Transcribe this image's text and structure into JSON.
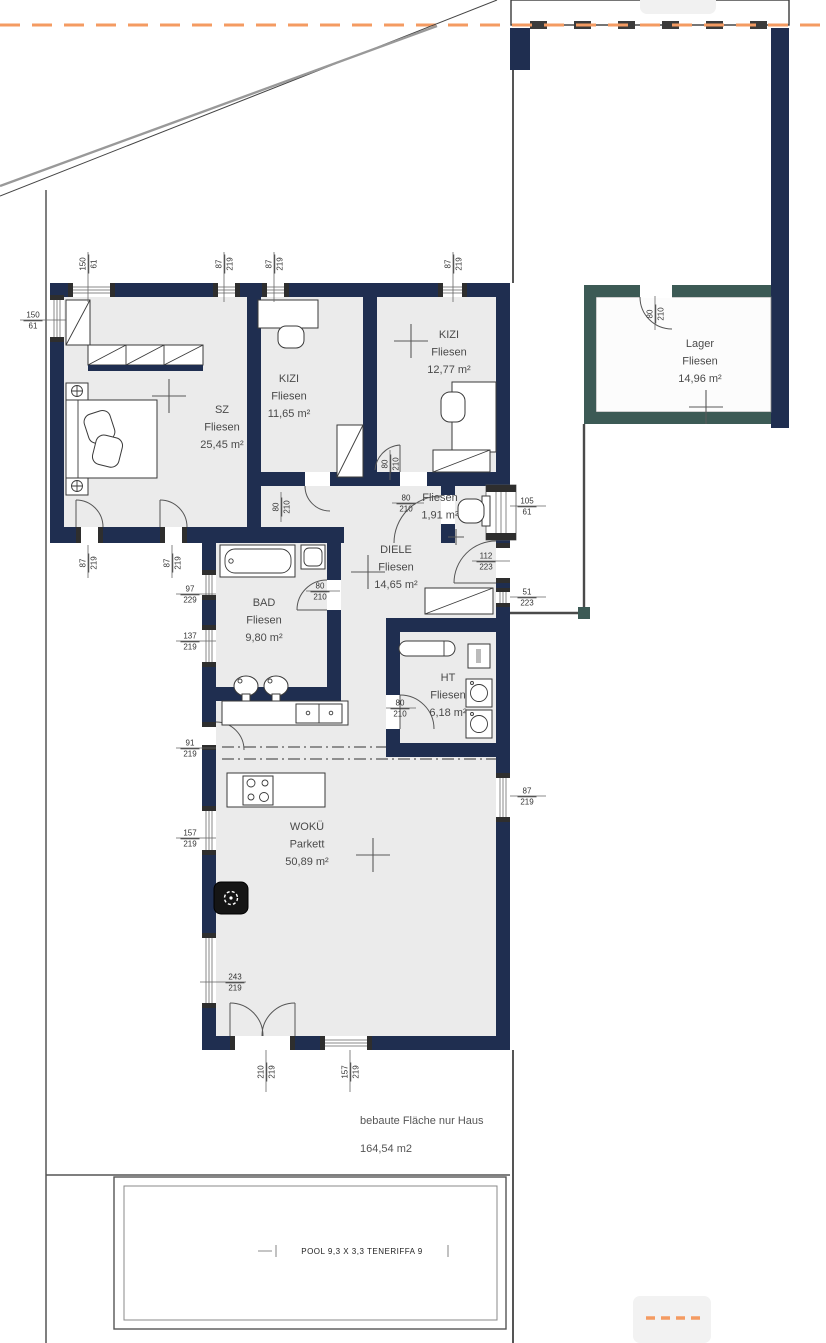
{
  "title": "Grundriss Einfamilienhaus",
  "colors": {
    "wall_navy": "#1f2e50",
    "wall_teal": "#3c5a55",
    "boundary_orange": "#f49b62",
    "floor_gray": "#ebebeb",
    "site_line_gray": "#555555"
  },
  "rooms": [
    {
      "lines": [
        "SZ",
        "Fliesen",
        "25,45 m²"
      ],
      "x": 222,
      "y": 413
    },
    {
      "lines": [
        "KIZI",
        "Fliesen",
        "11,65 m²"
      ],
      "x": 289,
      "y": 382
    },
    {
      "lines": [
        "KIZI",
        "Fliesen",
        "12,77 m²"
      ],
      "x": 449,
      "y": 338
    },
    {
      "lines": [
        "Fliesen",
        "1,91 m²"
      ],
      "x": 440,
      "y": 501
    },
    {
      "lines": [
        "DIELE",
        "Fliesen",
        "14,65 m²"
      ],
      "x": 396,
      "y": 553
    },
    {
      "lines": [
        "BAD",
        "Fliesen",
        "9,80 m²"
      ],
      "x": 264,
      "y": 606
    },
    {
      "lines": [
        "HT",
        "Fliesen",
        "6,18 m²"
      ],
      "x": 448,
      "y": 681
    },
    {
      "lines": [
        "WOKÜ",
        "Parkett",
        "50,89 m²"
      ],
      "x": 307,
      "y": 830
    },
    {
      "lines": [
        "Lager",
        "Fliesen",
        "14,96 m²"
      ],
      "x": 700,
      "y": 347
    }
  ],
  "dimensions": [
    {
      "t": "150",
      "b": "61",
      "x": 88,
      "y": 264,
      "rot": -90
    },
    {
      "t": "87",
      "b": "219",
      "x": 224,
      "y": 264,
      "rot": -90
    },
    {
      "t": "87",
      "b": "219",
      "x": 274,
      "y": 264,
      "rot": -90
    },
    {
      "t": "87",
      "b": "219",
      "x": 453,
      "y": 264,
      "rot": -90
    },
    {
      "t": "80",
      "b": "210",
      "x": 655,
      "y": 314,
      "rot": -90
    },
    {
      "t": "150",
      "b": "61",
      "x": 33,
      "y": 320,
      "rot": 0
    },
    {
      "t": "97",
      "b": "229",
      "x": 190,
      "y": 594,
      "rot": 0
    },
    {
      "t": "137",
      "b": "219",
      "x": 190,
      "y": 641,
      "rot": 0
    },
    {
      "t": "91",
      "b": "219",
      "x": 190,
      "y": 748,
      "rot": 0
    },
    {
      "t": "157",
      "b": "219",
      "x": 190,
      "y": 838,
      "rot": 0
    },
    {
      "t": "243",
      "b": "219",
      "x": 235,
      "y": 982,
      "rot": 0
    },
    {
      "t": "210",
      "b": "219",
      "x": 266,
      "y": 1072,
      "rot": -90
    },
    {
      "t": "157",
      "b": "219",
      "x": 350,
      "y": 1072,
      "rot": -90
    },
    {
      "t": "105",
      "b": "61",
      "x": 527,
      "y": 506,
      "rot": 0
    },
    {
      "t": "112",
      "b": "223",
      "x": 486,
      "y": 561,
      "rot": 0
    },
    {
      "t": "51",
      "b": "223",
      "x": 527,
      "y": 597,
      "rot": 0
    },
    {
      "t": "87",
      "b": "219",
      "x": 527,
      "y": 796,
      "rot": 0
    },
    {
      "t": "87",
      "b": "219",
      "x": 88,
      "y": 563,
      "rot": -90
    },
    {
      "t": "87",
      "b": "219",
      "x": 172,
      "y": 563,
      "rot": -90
    },
    {
      "t": "80",
      "b": "210",
      "x": 281,
      "y": 507,
      "rot": -90
    },
    {
      "t": "80",
      "b": "210",
      "x": 390,
      "y": 464,
      "rot": -90
    },
    {
      "t": "80",
      "b": "210",
      "x": 406,
      "y": 503,
      "rot": 0
    },
    {
      "t": "80",
      "b": "210",
      "x": 320,
      "y": 591,
      "rot": 0
    },
    {
      "t": "80",
      "b": "210",
      "x": 400,
      "y": 708,
      "rot": 0
    }
  ],
  "notes": {
    "built_area_label": "bebaute Fläche nur Haus",
    "built_area_value": "164,54 m2"
  },
  "pool": {
    "label": "POOL 9,3 X 3,3 TENERIFFA 9"
  }
}
